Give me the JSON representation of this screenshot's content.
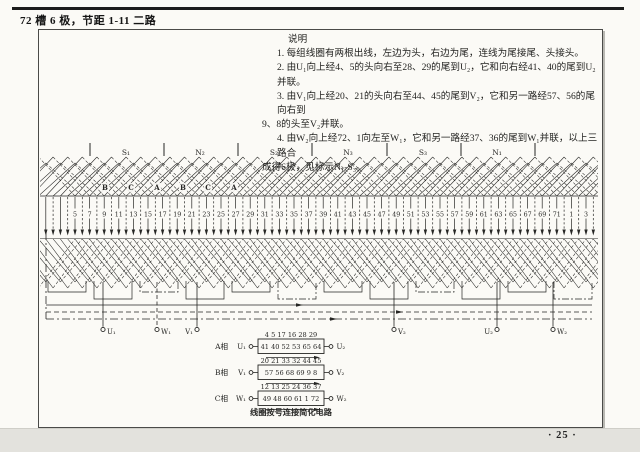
{
  "page": {
    "title": "72 槽 6 极，节距 1-11 二路",
    "page_number": "· 25 ·"
  },
  "notes": {
    "heading": "说明",
    "lines": [
      {
        "indent": 1,
        "text": "1. 每组线圈有两根出线，左边为头，右边为尾，连线为尾接尾、头接头。"
      },
      {
        "indent": 1,
        "text": "2. 由U₁向上经4、5的头向右至28、29的尾到U₂，它和向右经41、40的尾到U₂并联。"
      },
      {
        "indent": 1,
        "text": "3. 由V₁向上经20、21的头向右至44、45的尾到V₂，它和另一路经57、56的尾向右到"
      },
      {
        "indent": 0,
        "text": "9、8的头至V₂并联。"
      },
      {
        "indent": 1,
        "text": "4. 由W₂向上经72、1向左至W₁，它和另一路经37、36的尾到W₁并联，以上三路合"
      },
      {
        "indent": 0,
        "text": "成得6极，见标示N₁-S₃。"
      }
    ]
  },
  "diagram": {
    "pole_labels": [
      "S₁",
      "N₂",
      "S₂",
      "N₃",
      "S₃",
      "N₁"
    ],
    "phase_letters": [
      "B",
      "C",
      "A",
      "B",
      "C",
      "A"
    ],
    "slot_labels": [
      "5",
      "7",
      "9",
      "11",
      "13",
      "15",
      "17",
      "19",
      "21",
      "23",
      "25",
      "27",
      "29",
      "31",
      "33",
      "35",
      "37",
      "39",
      "41",
      "43",
      "45",
      "47",
      "49",
      "51",
      "53",
      "55",
      "57",
      "59",
      "61",
      "63",
      "65",
      "67",
      "69",
      "71",
      "1",
      "3"
    ],
    "terminals_left": [
      "U₁",
      "W₁",
      "V₁"
    ],
    "terminals_right": [
      "V₂",
      "U₂",
      "W₂"
    ],
    "slots": 72,
    "coil_pitch": "1-11",
    "line_color": "#262624",
    "paper_color": "#fbfaf6"
  },
  "circuit_table": {
    "rows": [
      {
        "phase": "A相",
        "left": "U₁",
        "right": "U₂",
        "top_path": "4  5  17  16  28  29",
        "box_path": "41  40  52  53  65  64"
      },
      {
        "phase": "B相",
        "left": "V₁",
        "right": "V₂",
        "top_path": "20  21  33  32  44  45",
        "box_path": "57  56  68  69  9  8"
      },
      {
        "phase": "C相",
        "left": "W₁",
        "right": "W₂",
        "top_path": "12  13  25  24  36  37",
        "box_path": "49  48  60  61  1  72"
      }
    ],
    "caption": "线圈按号连接简化电路"
  }
}
